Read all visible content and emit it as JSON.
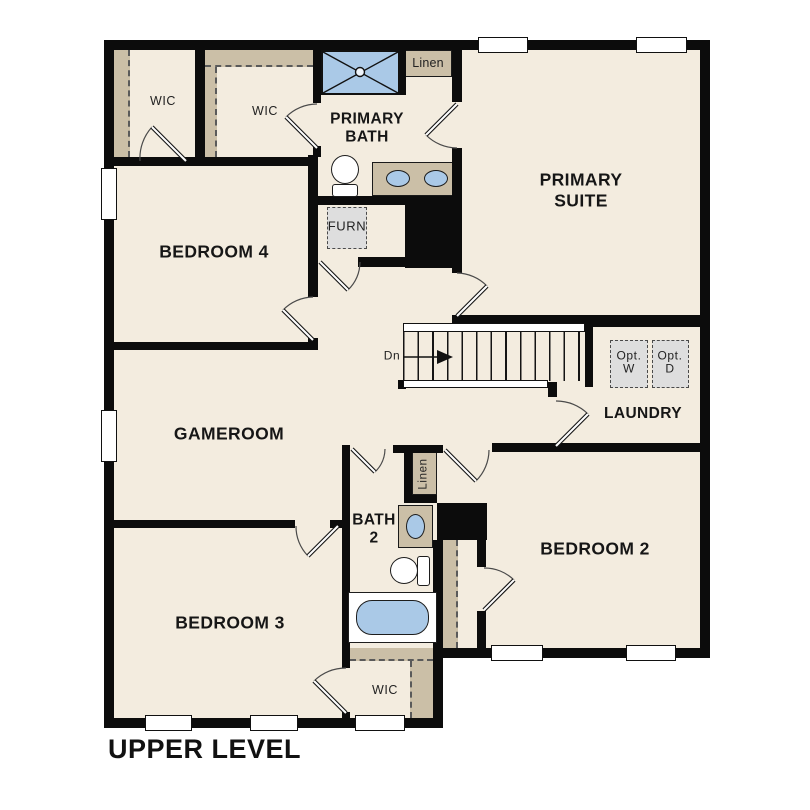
{
  "plan": {
    "title": "UPPER LEVEL",
    "colors": {
      "floor": "#f3ecdf",
      "wall": "#0c0c0c",
      "shelf": "#cbbfa7",
      "water": "#aac9e7",
      "appliance": "#dedede"
    },
    "labels": {
      "wic_upper_left": "WIC",
      "wic_primary": "WIC",
      "primary_bath": "PRIMARY\nBATH",
      "linen_primary": "Linen",
      "primary_suite": "PRIMARY\nSUITE",
      "bedroom4": "BEDROOM 4",
      "furnace": "FURN",
      "gameroom": "GAMEROOM",
      "stairs_dn": "Dn",
      "opt_washer": "Opt.\nW",
      "opt_dryer": "Opt.\nD",
      "laundry": "LAUNDRY",
      "linen_bath2": "Linen",
      "bath2": "BATH\n2",
      "bedroom2": "BEDROOM 2",
      "bedroom3": "BEDROOM 3",
      "wic_bedroom3": "WIC"
    }
  }
}
